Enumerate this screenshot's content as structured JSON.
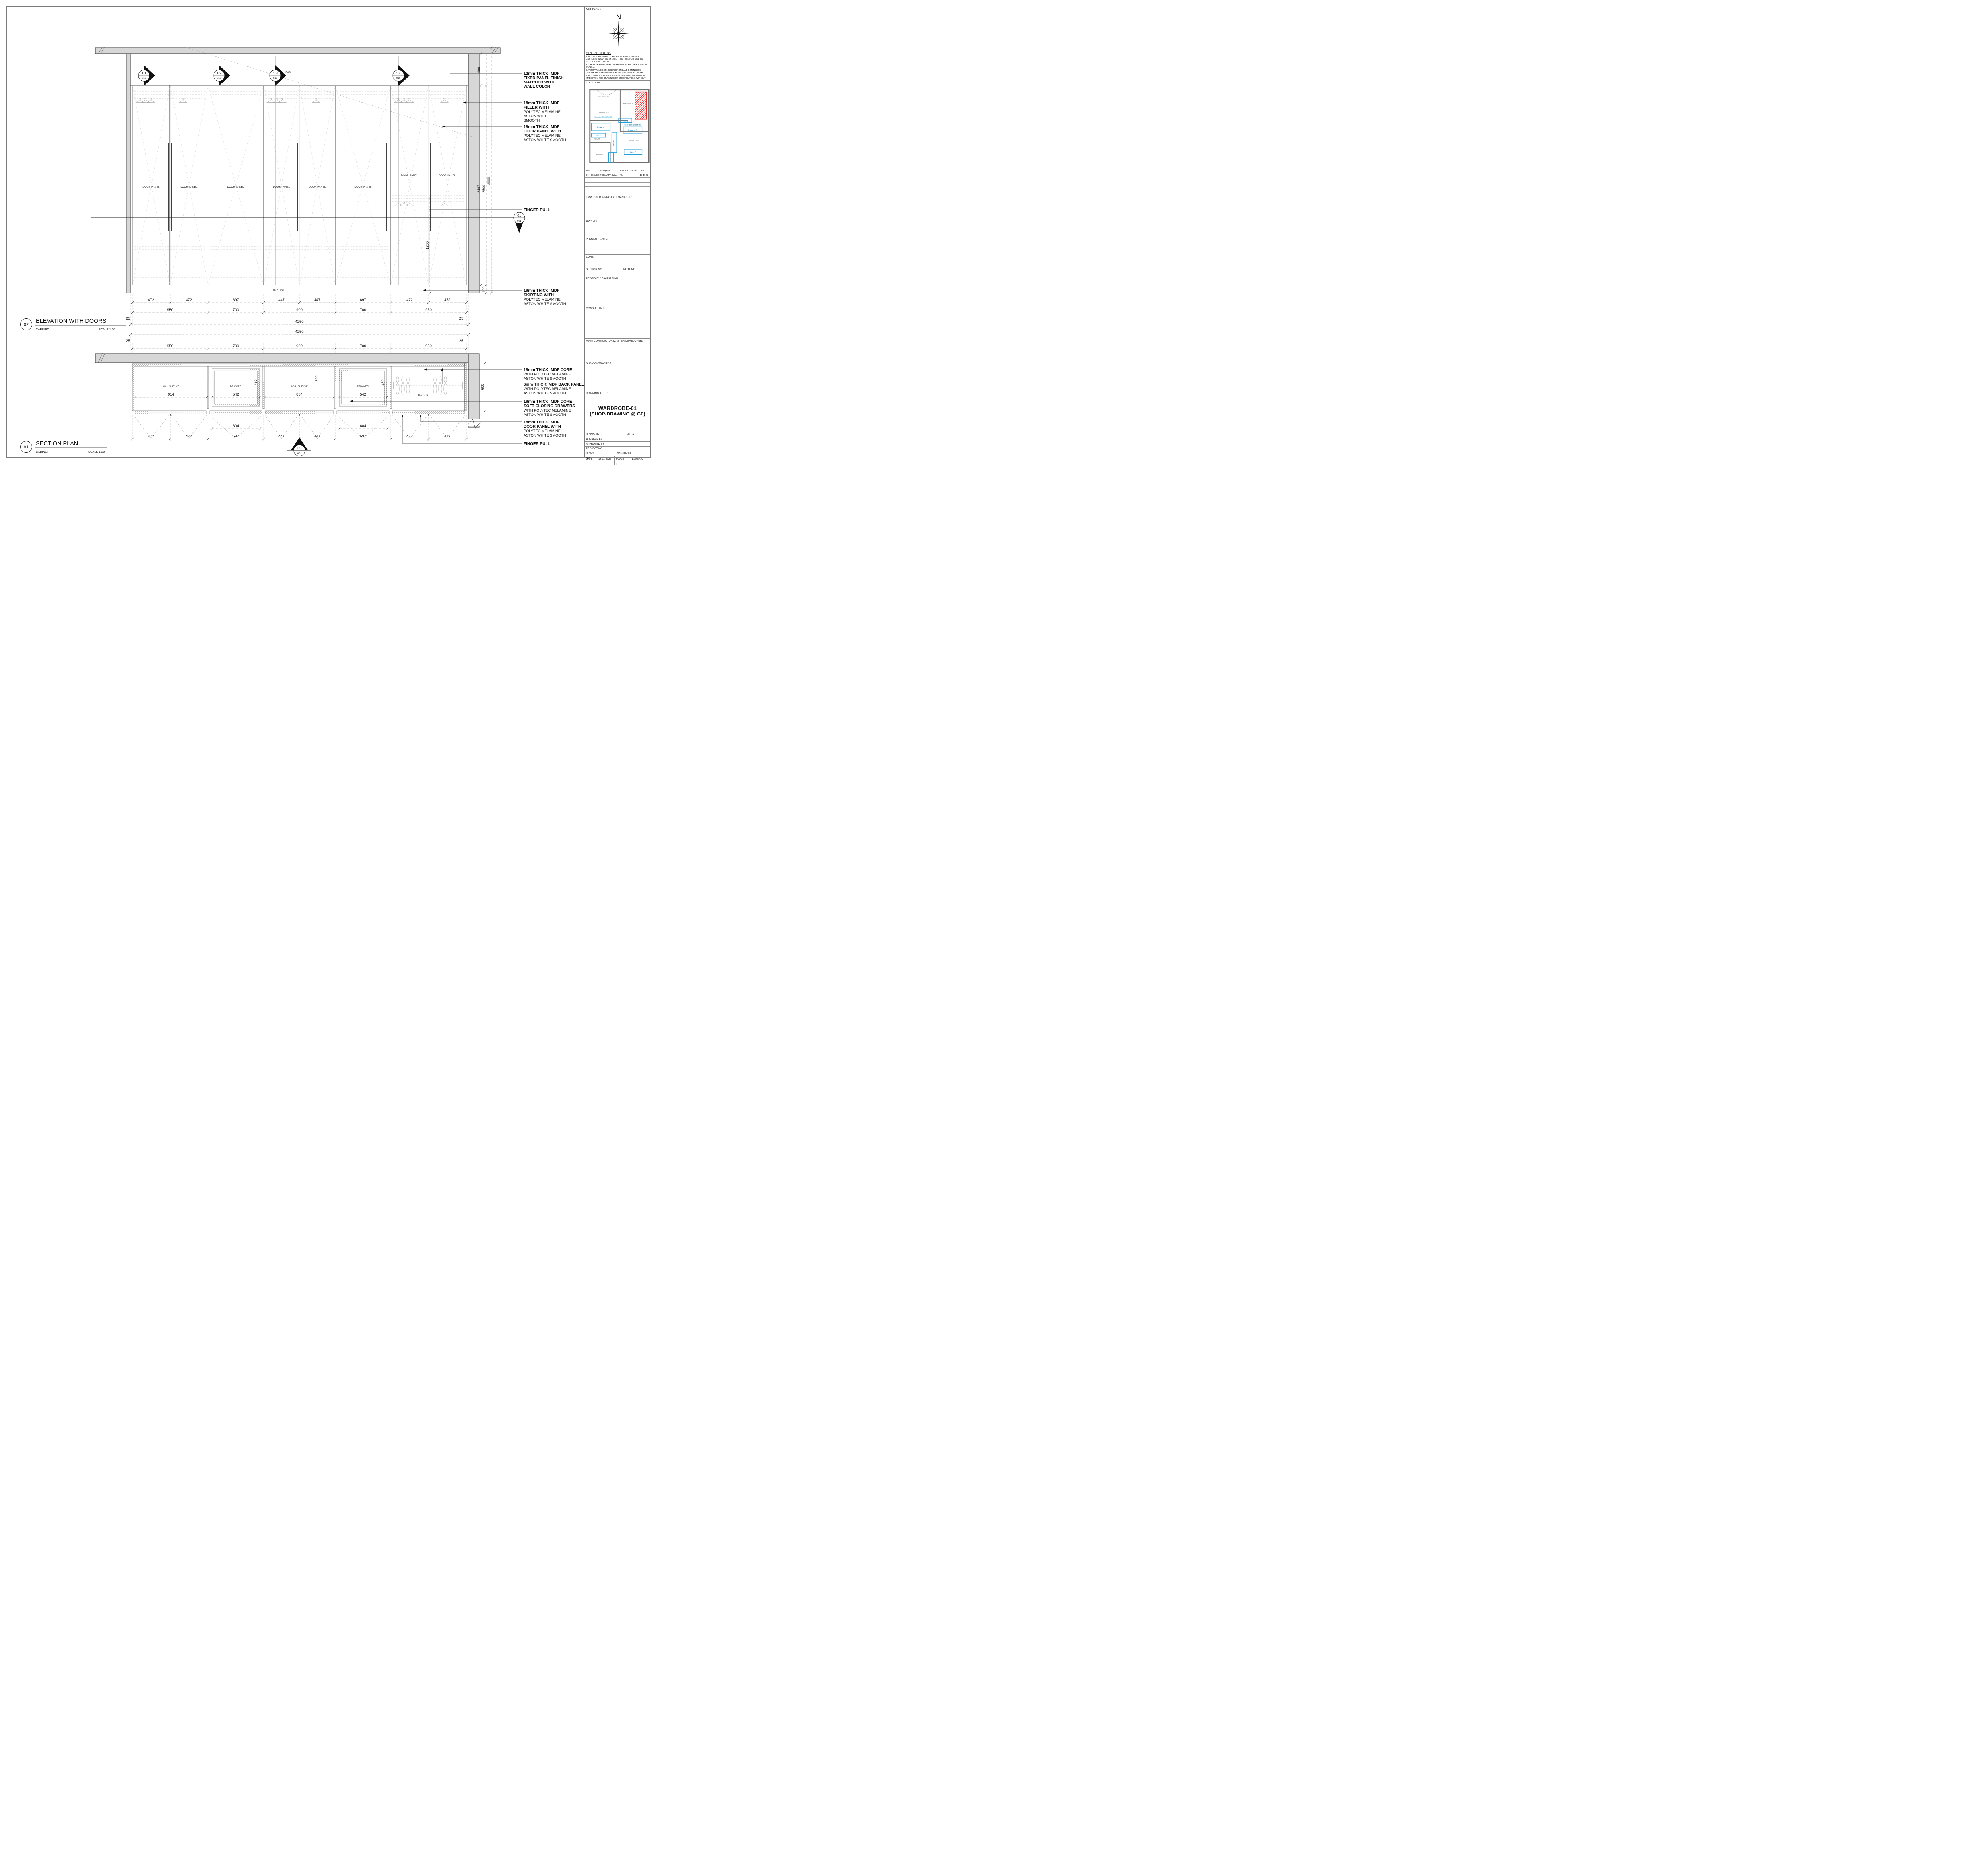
{
  "titles": {
    "elevation": {
      "num": "02",
      "name": "ELEVATION WITH DOORS",
      "sub": "CABINET",
      "scale": "SCALE  1:20"
    },
    "section": {
      "num": "01",
      "name": "SECTION PLAN",
      "sub": "CABINET",
      "scale": "SCALE  1:20"
    }
  },
  "labels": {
    "door_panel": "DOOR PANEL",
    "adj_shelve": "ADJ. SHELVE",
    "drawer": "DRAWER",
    "hanger": "HANGER",
    "skirting": "SKIRTING",
    "bulkhead": "BULKHEAD"
  },
  "markers": {
    "m1": "1.1",
    "m2": "1.2",
    "m3": "1.3",
    "m4": "1.4",
    "ref": "016",
    "sec01": "01",
    "sec02": "02",
    "sheet": "001"
  },
  "dims": {
    "d472": "472",
    "d447": "447",
    "d697": "697",
    "d950": "950",
    "d700": "700",
    "d900": "900",
    "d4250": "4250",
    "d25": "25",
    "v400": "400",
    "v2497": "2497",
    "v2500": "2500",
    "v3000": "3000",
    "v1200": "1200",
    "v100": "100",
    "s914": "914",
    "s542": "542",
    "s864": "864",
    "s450": "450",
    "s500": "500",
    "s600": "600",
    "s604": "604"
  },
  "ann": {
    "e1a": "12mm THICK: MDF",
    "e1b": "FIXED PANEL FINISH",
    "e1c": "MATCHED WITH",
    "e1d": "WALL COLOR",
    "e2a": "18mm THICK: MDF",
    "e2b": "FILLER WITH",
    "e2c": "POLYTEC MELAMINE",
    "e2d": "ASTON WHITE",
    "e2e": "SMOOTH",
    "e3a": "18mm THICK: MDF",
    "e3b": "DOOR PANEL WITH",
    "e3c": "POLYTEC MELAMINE",
    "e3d": "ASTON WHITE SMOOTH",
    "e4": "FINGER PULL",
    "e5a": "18mm THICK: MDF",
    "e5b": "SKIRTING WITH",
    "e5c": "POLYTEC MELAMINE",
    "e5d": "ASTON WHITE SMOOTH",
    "s1a": "18mm THICK: MDF CORE",
    "s1b": "WITH POLYTEC MELAMINE",
    "s1c": "ASTON WHITE SMOOTH",
    "s2a": "6mm THICK: MDF BACK PANEL",
    "s2b": "WITH POLYTEC MELAMINE",
    "s2c": "ASTON WHITE SMOOTH",
    "s3a": "18mm THICK: MDF CORE",
    "s3b": "SOFT CLOSING DRAWERS",
    "s3c": "WITH POLYTEC MELAMINE",
    "s3d": "ASTON WHITE SMOOTH",
    "s4a": "18mm THICK: MDF",
    "s4b": "DOOR PANEL WITH",
    "s4c": "POLYTEC MELAMINE",
    "s4d": "ASTON WHITE SMOOTH",
    "s5": "FINGER PULL"
  },
  "titleblock": {
    "key_plan_label": "KEY PLAN :-",
    "north_label": "N",
    "general_notes_label": "GENERAL NOTES:-",
    "notes": [
      "1. IT IS NOT ALLOWED TO REPRODUCE THIS SHEET'S  CONTENTS IN ANY FORM EXCEPT FOR THE PURPOSE  FOR WHICH IT IS INTENDED.",
      "2. THESE DRAWINGS ARE DIAGRAMMATIC AND SHALL NOT BE SCALED.",
      "3. VERIFY ALL EXISTING CONDITIONS AND DIMENSIONS  BEFORE PROCEEDING WITH ANY PORTION OF ANY WORK",
      "4. NO CHANGES, MODIFICATIONS OR DEVIATIONS SHALL BE  MADE FROM THE DRAWINGS OR SPECIFICATIONS WITHOUT  SECURING WRITTEN PERMISSION."
    ],
    "location_label": "LOCATION:-",
    "rev_table": {
      "headers": [
        "Rev",
        "Description",
        "DRN",
        "CKD",
        "APPD",
        "DATE"
      ],
      "row0": [
        "00",
        "ISSUED FOR APPROVAL",
        "TL",
        "",
        "",
        "13-11-22"
      ]
    },
    "employer_label": "EMPLOYER & PROJECT MANAGER:",
    "owner_label": "OWNER:",
    "project_name_label": "PROJECT NAME:",
    "zone_label": "ZONE:",
    "sector_label": "SECTOR NO. :",
    "plot_label": "PLOT NO. :",
    "project_desc_label": "PROJECT DESCRIPTION:",
    "consultant_label": "CONSULTANT:",
    "main_contractor_label": "MAIN CONTRACTOR/MASTER DEVELOPER:",
    "sub_contractor_label": "SUB CONTRACTOR:",
    "drawing_title_label": "DRAWING TITLE:",
    "drawing_title_line1": "WARDROBE-01",
    "drawing_title_line2": "(SHOP-DRAWING @ GF)",
    "drawn_by_label": "DRAWN BY",
    "colon": ":",
    "drawn_by_value": "TALHA",
    "checked_by_label": "CHECKED BY",
    "approved_by_label": "APPROVED BY :",
    "project_no_label": "PROJECT NO.",
    "drwg_no_label": "DRWG. NO.:",
    "drwg_no_value": "WD-SD-001",
    "date_label": "DATE:",
    "date_value": "13-11-2022",
    "scale_label": "SCALE :",
    "scale_value": "1:20 @ A3"
  },
  "loc": {
    "front_porch": "FRONT PORCH",
    "bedroom2": "BEDROOM 2",
    "bedroom1": "BEDROOM 1",
    "bedroom3": "BEDROOM 3",
    "ensuite": "ENSUITE",
    "rumpus": "RUMPUS",
    "bathroom": "BATHROOM",
    "item2": "Item 2",
    "item3": "Item - 3",
    "item4": "Item 4",
    "item5": "Item 5",
    "item6": "Item 6",
    "item7": "Item 7",
    "robe": "ROBE",
    "note1": "Wardrobe 2000x600x3000",
    "note2": "Floating Vanity 1200x450"
  },
  "colors": {
    "accent_cyan": "#1b9cd8",
    "highlight_red": "#e82020",
    "wall_gray": "#d7d7d7",
    "frame_gray": "#7a7a7a"
  }
}
